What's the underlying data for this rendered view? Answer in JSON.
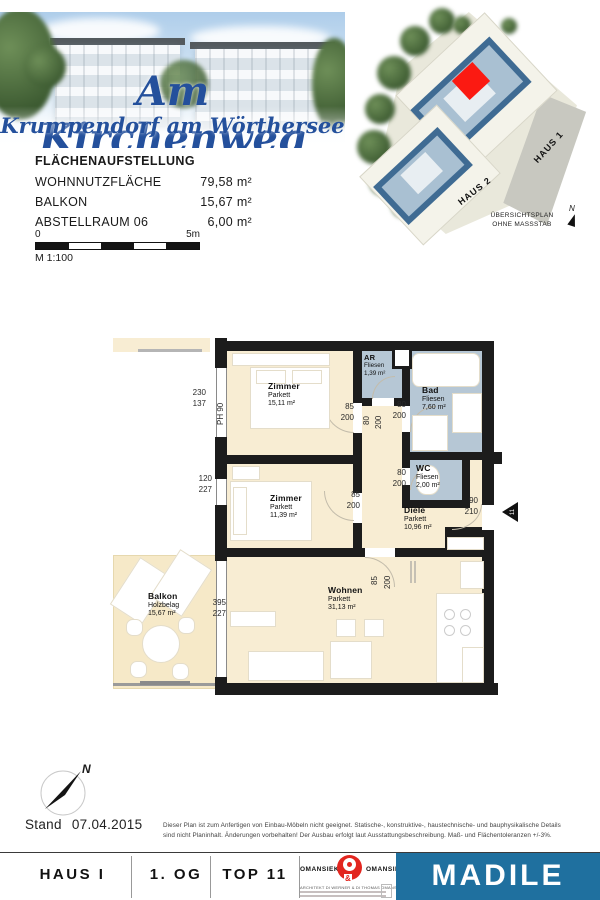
{
  "header": {
    "title": "Am Kirchenweg",
    "subtitle": "Krumpendorf am Wörthersee"
  },
  "site": {
    "haus1": "HAUS 1",
    "haus2": "HAUS 2",
    "note1": "ÜBERSICHTSPLAN",
    "note2": "OHNE MASSSTAB",
    "north": "N",
    "highlight_color": "#fb1a12"
  },
  "areas": {
    "title": "FLÄCHENAUFSTELLUNG",
    "rows": [
      {
        "label": "WOHNNUTZFLÄCHE",
        "value": "79,58 m²"
      },
      {
        "label": "BALKON",
        "value": "15,67 m²"
      },
      {
        "label": "ABSTELLRAUM 06",
        "value": "6,00 m²"
      }
    ]
  },
  "scale": {
    "zero": "0",
    "five": "5m",
    "ratio": "M 1:100"
  },
  "plan": {
    "rooms": [
      {
        "name": "Zimmer",
        "finish": "Parkett",
        "area": "15,11 m²"
      },
      {
        "name": "AR",
        "finish": "Fliesen",
        "area": "1,39 m²"
      },
      {
        "name": "Bad",
        "finish": "Fliesen",
        "area": "7,60 m²"
      },
      {
        "name": "WC",
        "finish": "Fliesen",
        "area": "2,00 m²"
      },
      {
        "name": "Zimmer",
        "finish": "Parkett",
        "area": "11,39 m²"
      },
      {
        "name": "Diele",
        "finish": "Parkett",
        "area": "10,96 m²"
      },
      {
        "name": "Wohnen",
        "finish": "Parkett",
        "area": "31,13 m²"
      },
      {
        "name": "Balkon",
        "finish": "Holzbelag",
        "area": "15,67 m²"
      }
    ],
    "dims": {
      "z1_window": {
        "w": "230",
        "h": "137"
      },
      "ph": "PH 90",
      "z1_door": {
        "w": "85",
        "h": "200"
      },
      "ar_door": {
        "w": "80",
        "h": "200"
      },
      "bad_door": {
        "w": "80",
        "h": "200"
      },
      "wc_door": {
        "w": "80",
        "h": "200"
      },
      "z2_door": {
        "w": "85",
        "h": "200"
      },
      "z2_window": {
        "w": "120",
        "h": "227"
      },
      "entrance": {
        "w": "90",
        "h": "210"
      },
      "wohnen_door": {
        "w": "85",
        "h": "200"
      },
      "balkon_window": {
        "w": "395",
        "h": "227"
      }
    },
    "entrance_no": "11"
  },
  "compass": {
    "north": "N"
  },
  "footer": {
    "stand": "Stand 07.04.2015",
    "disclaimer_line1": "Dieser Plan ist zum Anfertigen von Einbau-Möbeln nicht geeignet. Statische-, konstruktive-, haustechnische- und bauphysikalische Details",
    "disclaimer_line2": "sind nicht Planinhalt. Änderungen vorbehalten! Der Ausbau erfolgt laut Ausstattungsbeschreibung. Maß- und Flächentoleranzen +/-3%.",
    "haus": "HAUS I",
    "floor": "1. OG",
    "top": "TOP 11",
    "omansiek_left": "OMANSIEK",
    "omansiek_right": "OMANSIEK",
    "architect_line": "ARCHITEKT DI WERNER & DI THOMAS OMANSIEK",
    "madile": "MADILE",
    "madile_bg": "#1f709f",
    "logo_red": "#e2261f"
  }
}
